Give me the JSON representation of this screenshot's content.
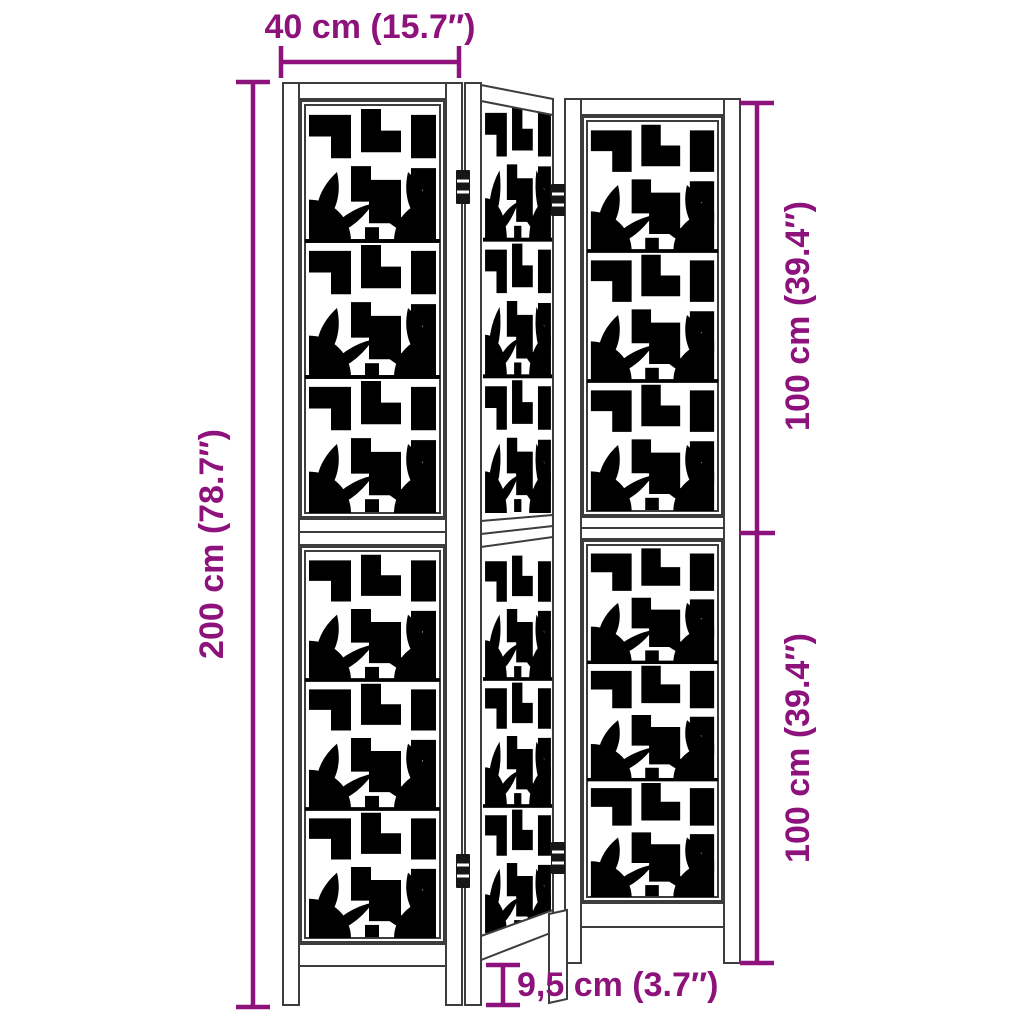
{
  "product": {
    "name": "Room divider with 3 decorative fretwork panels",
    "panel_count": 3,
    "hinge_count": 4
  },
  "colors": {
    "background": "#ffffff",
    "drawing_line": "#3d3d3d",
    "dimension_accent": "#8D127B"
  },
  "dimensions": {
    "top_width": "40 cm (15.7″)",
    "total_height": "200 cm (78.7″)",
    "upper_panel_height": "100 cm (39.4″)",
    "lower_panel_height": "100 cm (39.4″)",
    "foot_clearance": "9,5 cm (3.7″)"
  }
}
